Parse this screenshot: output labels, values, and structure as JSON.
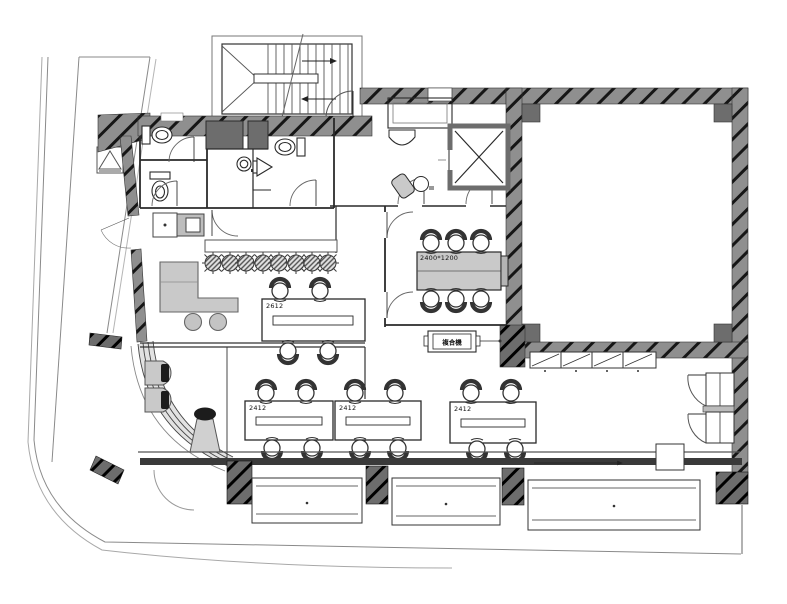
{
  "labels": {
    "conference_table_size": "2400*1200",
    "table_2612": "2612",
    "table_2412": "2412",
    "copier": "複合機"
  },
  "colors": {
    "background": "#ffffff",
    "wall_fill": "#8f8f8f",
    "wall_dark": "#6d6d6d",
    "line": "#2a2a2a",
    "furniture_fill": "#c9c9c9",
    "furniture_dark": "#1c1c1c",
    "boundary": "#8a8a8a"
  },
  "fixtures": [
    "staircase",
    "elevator",
    "toilet",
    "urinal",
    "wash-basin",
    "kitchenette",
    "planter-row",
    "l-shaped-desk",
    "meeting-table",
    "office-desk",
    "task-chair",
    "lounge-chair",
    "reception-counter",
    "copier",
    "storage-cabinets",
    "shelf-rack",
    "window-wall",
    "site-boundary",
    "fire-equipment-symbol"
  ]
}
